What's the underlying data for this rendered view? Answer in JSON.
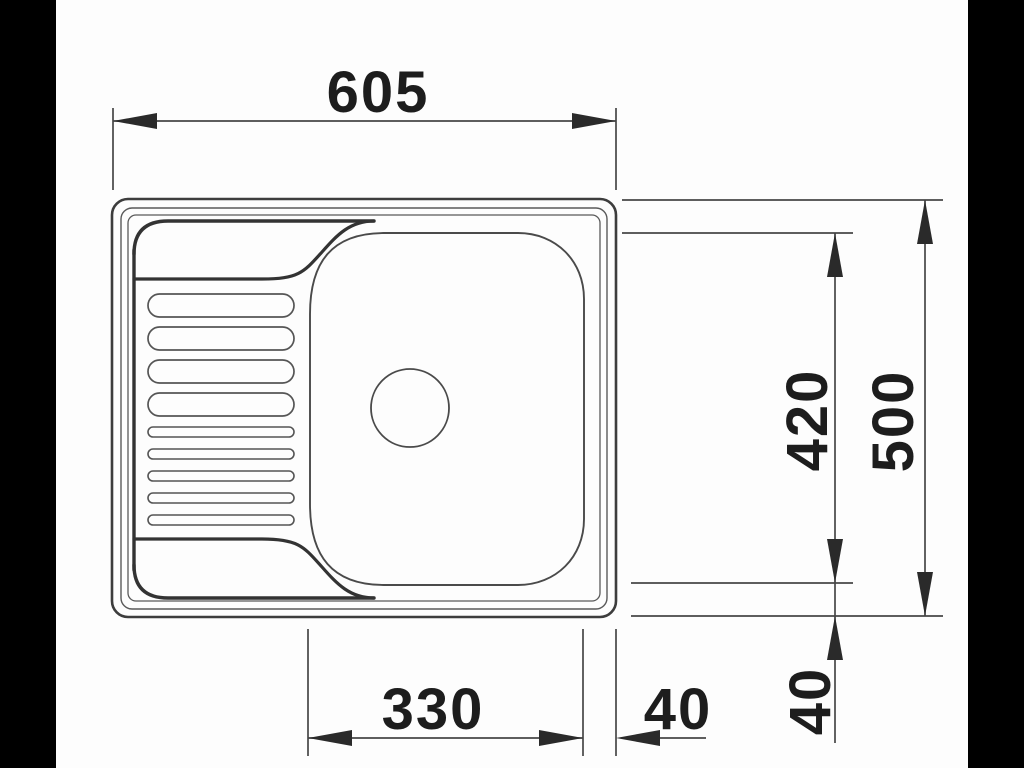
{
  "drawing": {
    "subject": "kitchen-sink-top-view-technical-drawing",
    "dimensions": {
      "overall_width": "605",
      "overall_depth": "500",
      "bowl_length": "420",
      "bowl_width": "330",
      "bowl_to_edge_horizontal": "40",
      "bowl_to_edge_vertical": "40"
    },
    "colors": {
      "letterbox": "#000000",
      "paper": "#fdfdfd",
      "dimension_line": "#474747",
      "outline": "#3d3d3d",
      "accent_edge": "#333333",
      "text": "#1d1d1d"
    }
  }
}
